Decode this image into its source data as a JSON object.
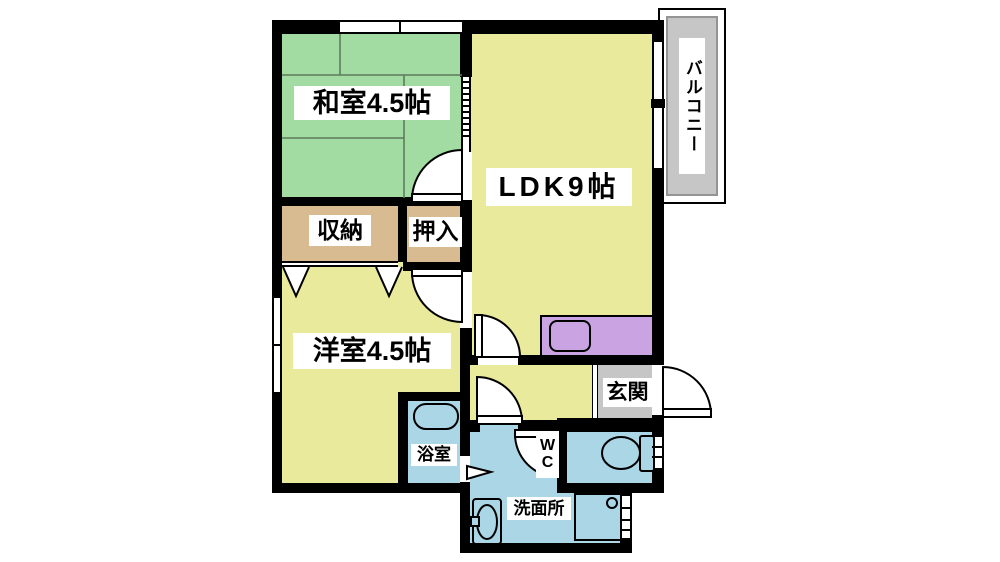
{
  "rooms": {
    "washitsu": {
      "label": "和室4.5帖"
    },
    "ldk": {
      "label": "LDK9帖"
    },
    "balcony": {
      "label": "バルコニー"
    },
    "shunou": {
      "label": "収納"
    },
    "oshiire": {
      "label": "押入"
    },
    "youshitsu": {
      "label": "洋室4.5帖"
    },
    "genkan": {
      "label": "玄関"
    },
    "wc": {
      "label": "WC"
    },
    "yokushitsu": {
      "label": "浴室"
    },
    "senmenjo": {
      "label": "洗面所"
    }
  },
  "palette": {
    "wall": "#000000",
    "tatami_room": "#a3dca3",
    "living_room": "#eaea9c",
    "closet": "#d9bb91",
    "wet_area": "#aad6e6",
    "kitchen_counter": "#c9a3e2",
    "balcony_floor": "#c6c6c6",
    "entry_floor": "#c6c6c6",
    "background": "#ffffff"
  }
}
